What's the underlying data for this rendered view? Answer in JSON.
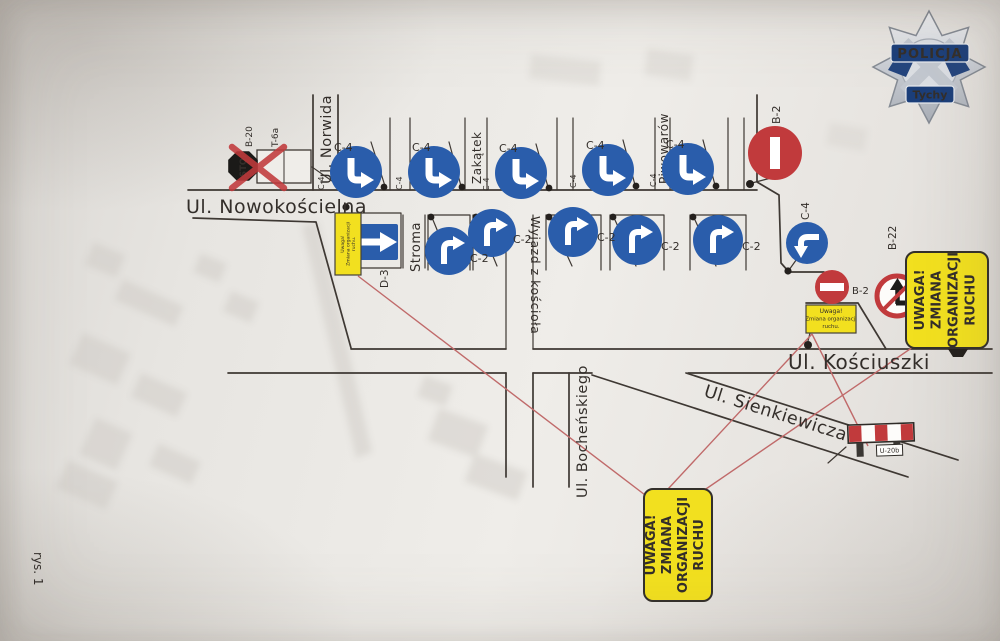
{
  "figure": {
    "caption": "rys. 1"
  },
  "badge": {
    "title": "POLICJA",
    "subtitle": "Tychy"
  },
  "streets": {
    "nowokoscielna": "Ul. Nowokościelna",
    "norwida": "Ul. Norwida",
    "stroma": "Stroma",
    "zakatek": "Zakątek",
    "piwowarow": "Piwowarów",
    "wyjazd": "Wyjazd z kościoła",
    "kosciuszki": "Ul. Kościuszki",
    "sienkiewicza": "Ul. Sienkiewicza",
    "bochenskiego": "Ul. Bocheńskiego"
  },
  "warning_box": {
    "lines": [
      "UWAGA!",
      "ZMIANA",
      "ORGANIZACJI",
      "RUCHU"
    ]
  },
  "note_box": {
    "lines": [
      "Uwaga!",
      "Zmiana organizacji",
      "ruchu."
    ]
  },
  "signs": {
    "top_row": [
      {
        "code": "C-4"
      },
      {
        "code": "C-4"
      },
      {
        "code": "C-4"
      },
      {
        "code": "C-4"
      },
      {
        "code": "C-4"
      }
    ],
    "middle_row": [
      {
        "code": "C-2"
      },
      {
        "code": "C-2"
      },
      {
        "code": "C-2"
      },
      {
        "code": "C-2"
      },
      {
        "code": "C-2"
      }
    ],
    "d3": {
      "code": "D-3"
    },
    "stop": {
      "text": "STOP",
      "code": "B-20",
      "plate": "T-6a"
    },
    "b2_top": {
      "code": "B-2"
    },
    "b2_mid": {
      "code": "B-2"
    },
    "b22": {
      "code": "B-22"
    },
    "c4_right": {
      "code": "C-4"
    },
    "barrier": {
      "code": "U-20b"
    }
  },
  "colors": {
    "sign_blue": "#2a5dab",
    "sign_red": "#c13a3c",
    "warning_yellow": "#f2e01f",
    "leader_red": "#c06a6a",
    "ink": "#3e3833"
  }
}
